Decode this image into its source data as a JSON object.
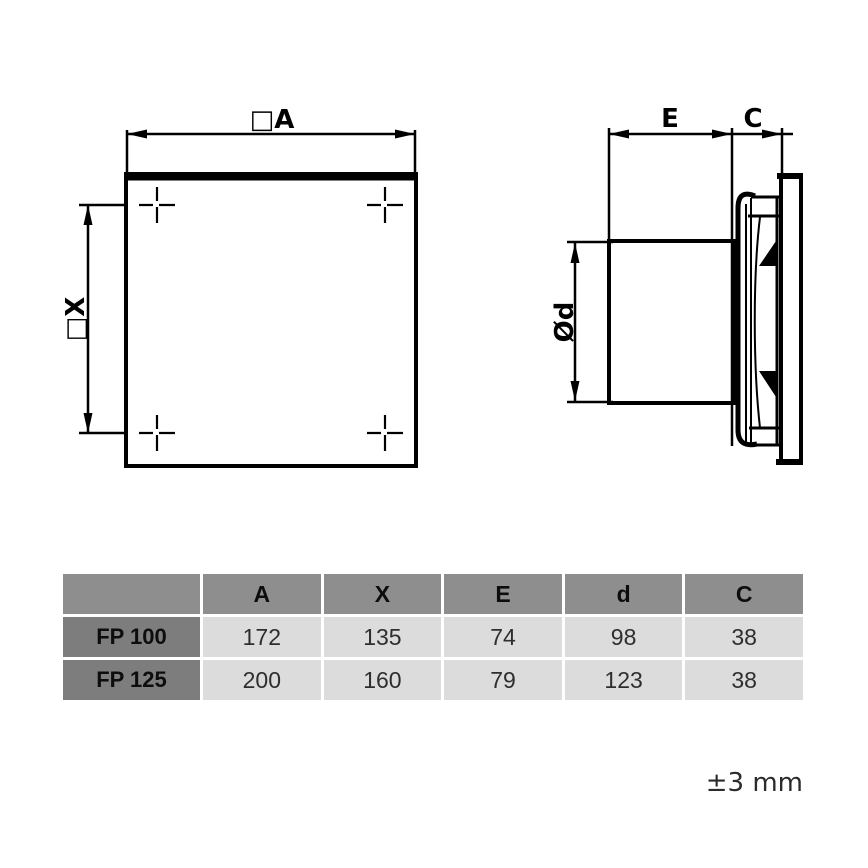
{
  "drawing": {
    "front_view": {
      "width_label": "□A",
      "hole_spacing_label": "□X"
    },
    "side_view": {
      "duct_length_label": "E",
      "panel_depth_label": "C",
      "duct_diameter_label": "Ød"
    },
    "tolerance_note": "±3 mm"
  },
  "table": {
    "columns": [
      "",
      "A",
      "X",
      "E",
      "d",
      "C"
    ],
    "rows": [
      {
        "model": "FP 100",
        "values": [
          "172",
          "135",
          "74",
          "98",
          "38"
        ]
      },
      {
        "model": "FP 125",
        "values": [
          "200",
          "160",
          "79",
          "123",
          "38"
        ]
      }
    ]
  },
  "colors": {
    "line": "#000000",
    "header_bg": "#8e8e8e",
    "model_bg": "#7d7d7d",
    "cell_bg": "#dcdcdc",
    "background": "#ffffff"
  }
}
